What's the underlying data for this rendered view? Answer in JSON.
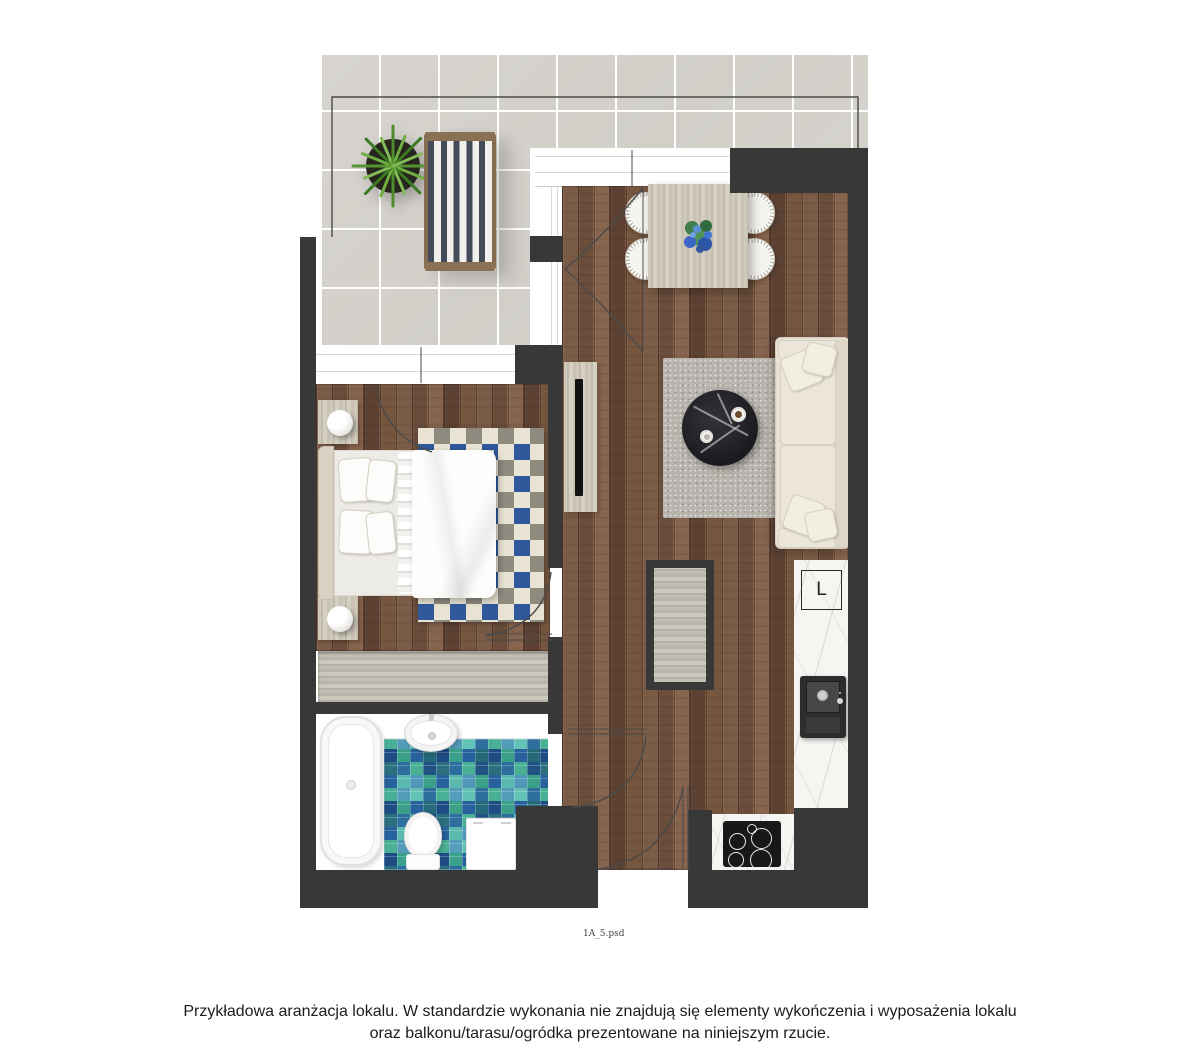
{
  "plan": {
    "fridge_label": "L",
    "colors": {
      "wall": "#383838",
      "wood_floor": "#7b5c47",
      "terrace_tile": "#d4d1cb",
      "bedroom_rug_blue": "#30589b",
      "mosaic_teal": "#3aa08a",
      "mosaic_blue": "#2e6e9e",
      "sofa": "#e7e1d5",
      "marble": "#f6f5f2",
      "deckchair_stripe": "#454c59"
    }
  },
  "footer": {
    "filename": "1A_5.psd",
    "disclaimer_line1": "Przykładowa aranżacja lokalu. W standardzie wykonania nie znajdują się elementy wykończenia i wyposażenia lokalu",
    "disclaimer_line2": "oraz balkonu/tarasu/ogródka prezentowane na niniejszym rzucie."
  }
}
